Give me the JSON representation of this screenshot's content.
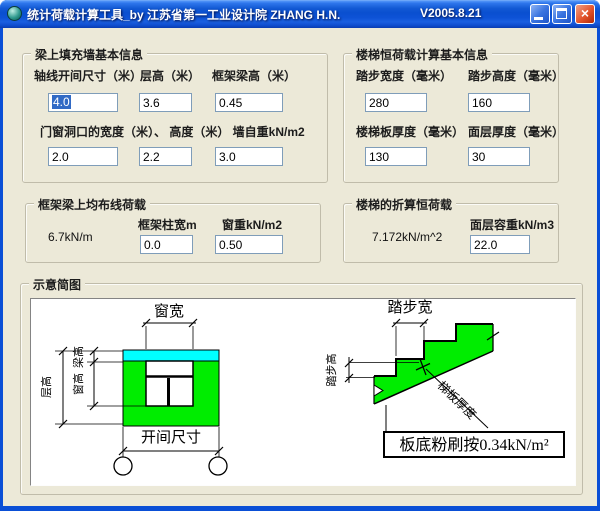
{
  "window": {
    "title": "统计荷载计算工具_by 江苏省第一工业设计院 ZHANG H.N.",
    "version": "V2005.8.21",
    "icons": {
      "app": "app-icon",
      "minimize": "minimize-icon",
      "maximize": "maximize-icon",
      "close": "close-icon",
      "close_glyph": "×"
    },
    "colors": {
      "titlebar_blue": "#0a4fd0",
      "client_beige": "#ECE9D8",
      "selection_blue": "#316AC5",
      "textbox_border": "#7F9DB9"
    }
  },
  "wall": {
    "title": "梁上填充墙基本信息",
    "row1": [
      {
        "label": "轴线开间尺寸（米）",
        "value": "4.0"
      },
      {
        "label": "层高（米）",
        "value": "3.6"
      },
      {
        "label": "框架梁高（米）",
        "value": "0.45"
      }
    ],
    "row2_label": "门窗洞口的宽度（米）、 高度（米）  墙自重kN/m2",
    "row2": [
      {
        "value": "2.0"
      },
      {
        "value": "2.2"
      },
      {
        "value": "3.0"
      }
    ]
  },
  "stair_info": {
    "title": "楼梯恒荷载计算基本信息",
    "fields": [
      {
        "label": "踏步宽度（毫米）",
        "value": "280"
      },
      {
        "label": "踏步高度（毫米）",
        "value": "160"
      },
      {
        "label": "楼梯板厚度（毫米）",
        "value": "130"
      },
      {
        "label": "面层厚度（毫米）",
        "value": "30"
      }
    ]
  },
  "beam_load": {
    "title": "框架梁上均布线荷载",
    "result": "6.7kN/m",
    "fields": [
      {
        "label": "框架柱宽m",
        "value": "0.0"
      },
      {
        "label": "窗重kN/m2",
        "value": "0.50"
      }
    ]
  },
  "stair_load": {
    "title": "楼梯的折算恒荷载",
    "result": "7.172kN/m^2",
    "fields": [
      {
        "label": "面层容重kN/m3",
        "value": "22.0"
      }
    ]
  },
  "diagram": {
    "title": "示意简图",
    "labels": {
      "window_width": "窗宽",
      "beam_height": "梁高",
      "window_height": "窗高",
      "floor_height": "层高",
      "bay_size": "开间尺寸",
      "tread_width": "踏步宽",
      "riser_height": "踏步高",
      "slab_thickness": "梯板厚度",
      "plaster_note": "板底粉刷按0.34kN/m²"
    },
    "colors": {
      "wall_green": "#00ED00",
      "beam_cyan": "#00FFFF"
    }
  }
}
